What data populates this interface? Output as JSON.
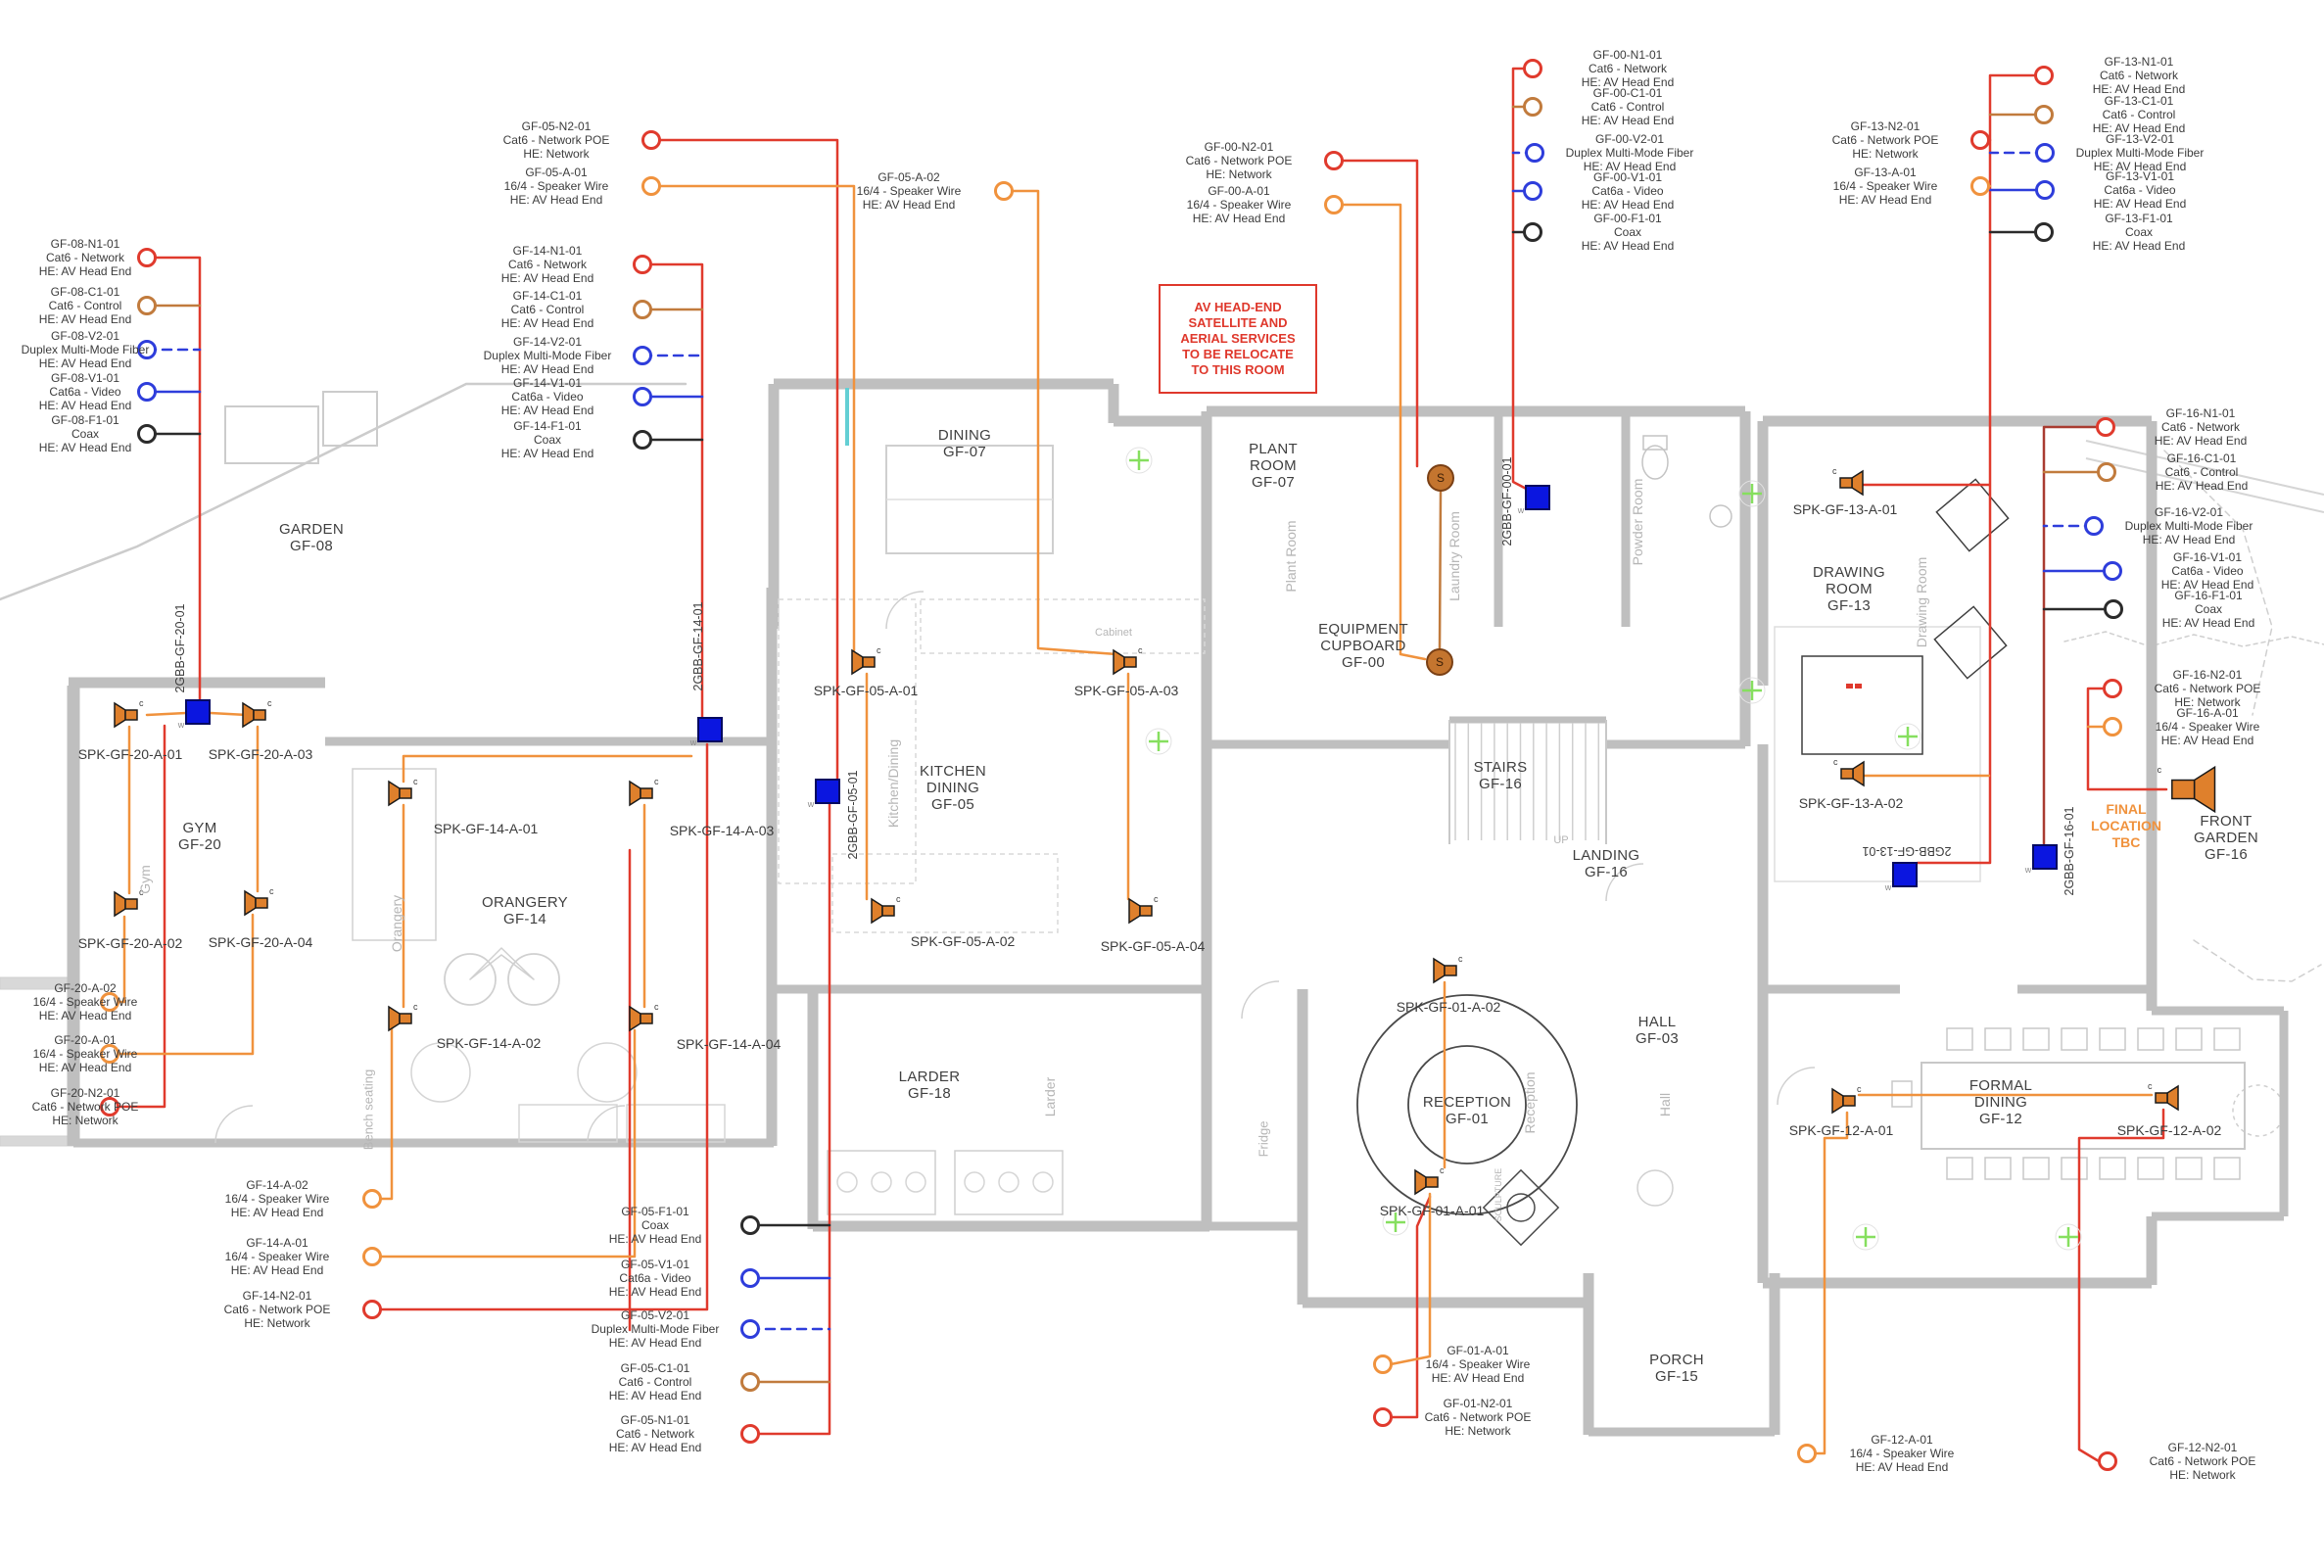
{
  "title": "Ground Floor AV / Speaker Cabling Plan",
  "colors": {
    "network": "#e03a2d",
    "network_poe": "#e03a2d",
    "control": "#c17b3d",
    "video": "#2e3ddb",
    "fiber": "#2e3ddb",
    "coax": "#2b2b2b",
    "speaker_wire": "#f0923d",
    "speaker_icon": "#df802c",
    "distribution_box": "#0b16e0",
    "wall_gray": "#bfbfbf",
    "annotation_gray": "#b6b6b6",
    "light_marker_green": "#86df5f",
    "note_red": "#df382c",
    "note_orange": "#f0923d"
  },
  "callout_groups": [
    {
      "name": "GF-08",
      "items": [
        {
          "id": "GF-08-N1-01",
          "cable": "Cat6 - Network",
          "dest": "HE: AV Head End",
          "type": "network"
        },
        {
          "id": "GF-08-C1-01",
          "cable": "Cat6 - Control",
          "dest": "HE: AV Head End",
          "type": "control"
        },
        {
          "id": "GF-08-V2-01",
          "cable": "Duplex Multi-Mode Fiber",
          "dest": "HE: AV Head End",
          "type": "fiber"
        },
        {
          "id": "GF-08-V1-01",
          "cable": "Cat6a - Video",
          "dest": "HE: AV Head End",
          "type": "video"
        },
        {
          "id": "GF-08-F1-01",
          "cable": "Coax",
          "dest": "HE: AV Head End",
          "type": "coax"
        }
      ]
    },
    {
      "name": "GF-05 head-end",
      "items": [
        {
          "id": "GF-05-N2-01",
          "cable": "Cat6 - Network POE",
          "dest": "HE: Network",
          "type": "network_poe"
        },
        {
          "id": "GF-05-A-01",
          "cable": "16/4 - Speaker Wire",
          "dest": "HE: AV Head End",
          "type": "speaker_wire"
        }
      ]
    },
    {
      "name": "GF-05 speaker 2",
      "items": [
        {
          "id": "GF-05-A-02",
          "cable": "16/4 - Speaker Wire",
          "dest": "HE: AV Head End",
          "type": "speaker_wire"
        }
      ]
    },
    {
      "name": "GF-14",
      "items": [
        {
          "id": "GF-14-N1-01",
          "cable": "Cat6 - Network",
          "dest": "HE: AV Head End",
          "type": "network"
        },
        {
          "id": "GF-14-C1-01",
          "cable": "Cat6 - Control",
          "dest": "HE: AV Head End",
          "type": "control"
        },
        {
          "id": "GF-14-V2-01",
          "cable": "Duplex Multi-Mode Fiber",
          "dest": "HE: AV Head End",
          "type": "fiber"
        },
        {
          "id": "GF-14-V1-01",
          "cable": "Cat6a - Video",
          "dest": "HE: AV Head End",
          "type": "video"
        },
        {
          "id": "GF-14-F1-01",
          "cable": "Coax",
          "dest": "HE: AV Head End",
          "type": "coax"
        }
      ]
    },
    {
      "name": "GF-00 poe",
      "items": [
        {
          "id": "GF-00-N2-01",
          "cable": "Cat6 - Network POE",
          "dest": "HE: Network",
          "type": "network_poe"
        },
        {
          "id": "GF-00-A-01",
          "cable": "16/4 - Speaker Wire",
          "dest": "HE: AV Head End",
          "type": "speaker_wire"
        }
      ]
    },
    {
      "name": "GF-00",
      "items": [
        {
          "id": "GF-00-N1-01",
          "cable": "Cat6 - Network",
          "dest": "HE: AV Head End",
          "type": "network"
        },
        {
          "id": "GF-00-C1-01",
          "cable": "Cat6 - Control",
          "dest": "HE: AV Head End",
          "type": "control"
        },
        {
          "id": "GF-00-V2-01",
          "cable": "Duplex Multi-Mode Fiber",
          "dest": "HE: AV Head End",
          "type": "fiber"
        },
        {
          "id": "GF-00-V1-01",
          "cable": "Cat6a - Video",
          "dest": "HE: AV Head End",
          "type": "video"
        },
        {
          "id": "GF-00-F1-01",
          "cable": "Coax",
          "dest": "HE: AV Head End",
          "type": "coax"
        }
      ]
    },
    {
      "name": "GF-13 poe",
      "items": [
        {
          "id": "GF-13-N2-01",
          "cable": "Cat6 - Network POE",
          "dest": "HE: Network",
          "type": "network_poe"
        },
        {
          "id": "GF-13-A-01",
          "cable": "16/4 - Speaker Wire",
          "dest": "HE: AV Head End",
          "type": "speaker_wire"
        }
      ]
    },
    {
      "name": "GF-13",
      "items": [
        {
          "id": "GF-13-N1-01",
          "cable": "Cat6 - Network",
          "dest": "HE: AV Head End",
          "type": "network"
        },
        {
          "id": "GF-13-C1-01",
          "cable": "Cat6 - Control",
          "dest": "HE: AV Head End",
          "type": "control"
        },
        {
          "id": "GF-13-V2-01",
          "cable": "Duplex Multi-Mode Fiber",
          "dest": "HE: AV Head End",
          "type": "fiber"
        },
        {
          "id": "GF-13-V1-01",
          "cable": "Cat6a - Video",
          "dest": "HE: AV Head End",
          "type": "video"
        },
        {
          "id": "GF-13-F1-01",
          "cable": "Coax",
          "dest": "HE: AV Head End",
          "type": "coax"
        }
      ]
    },
    {
      "name": "GF-16",
      "items": [
        {
          "id": "GF-16-N1-01",
          "cable": "Cat6 - Network",
          "dest": "HE: AV Head End",
          "type": "network"
        },
        {
          "id": "GF-16-C1-01",
          "cable": "Cat6 - Control",
          "dest": "HE: AV Head End",
          "type": "control"
        },
        {
          "id": "GF-16-V2-01",
          "cable": "Duplex Multi-Mode Fiber",
          "dest": "HE: AV Head End",
          "type": "fiber"
        },
        {
          "id": "GF-16-V1-01",
          "cable": "Cat6a - Video",
          "dest": "HE: AV Head End",
          "type": "video"
        },
        {
          "id": "GF-16-F1-01",
          "cable": "Coax",
          "dest": "HE: AV Head End",
          "type": "coax"
        }
      ]
    },
    {
      "name": "GF-16 poe",
      "items": [
        {
          "id": "GF-16-N2-01",
          "cable": "Cat6 - Network POE",
          "dest": "HE: Network",
          "type": "network_poe"
        },
        {
          "id": "GF-16-A-01",
          "cable": "16/4 - Speaker Wire",
          "dest": "HE: AV Head End",
          "type": "speaker_wire"
        }
      ]
    },
    {
      "name": "GF-20 tails",
      "items": [
        {
          "id": "GF-20-A-02",
          "cable": "16/4 - Speaker Wire",
          "dest": "HE: AV Head End",
          "type": "speaker_wire"
        },
        {
          "id": "GF-20-A-01",
          "cable": "16/4 - Speaker Wire",
          "dest": "HE: AV Head End",
          "type": "speaker_wire"
        },
        {
          "id": "GF-20-N2-01",
          "cable": "Cat6 - Network POE",
          "dest": "HE: Network",
          "type": "network_poe"
        }
      ]
    },
    {
      "name": "GF-14 tails",
      "items": [
        {
          "id": "GF-14-A-02",
          "cable": "16/4 - Speaker Wire",
          "dest": "HE: AV Head End",
          "type": "speaker_wire"
        },
        {
          "id": "GF-14-A-01",
          "cable": "16/4 - Speaker Wire",
          "dest": "HE: AV Head End",
          "type": "speaker_wire"
        },
        {
          "id": "GF-14-N2-01",
          "cable": "Cat6 - Network POE",
          "dest": "HE: Network",
          "type": "network_poe"
        }
      ]
    },
    {
      "name": "GF-05 tails",
      "items": [
        {
          "id": "GF-05-F1-01",
          "cable": "Coax",
          "dest": "HE: AV Head End",
          "type": "coax"
        },
        {
          "id": "GF-05-V1-01",
          "cable": "Cat6a - Video",
          "dest": "HE: AV Head End",
          "type": "video"
        },
        {
          "id": "GF-05-V2-01",
          "cable": "Duplex Multi-Mode Fiber",
          "dest": "HE: AV Head End",
          "type": "fiber"
        },
        {
          "id": "GF-05-C1-01",
          "cable": "Cat6 - Control",
          "dest": "HE: AV Head End",
          "type": "control"
        },
        {
          "id": "GF-05-N1-01",
          "cable": "Cat6 - Network",
          "dest": "HE: AV Head End",
          "type": "network"
        }
      ]
    },
    {
      "name": "GF-01 tails",
      "items": [
        {
          "id": "GF-01-A-01",
          "cable": "16/4 - Speaker Wire",
          "dest": "HE: AV Head End",
          "type": "speaker_wire"
        },
        {
          "id": "GF-01-N2-01",
          "cable": "Cat6 - Network POE",
          "dest": "HE: Network",
          "type": "network_poe"
        }
      ]
    },
    {
      "name": "GF-12 speaker",
      "items": [
        {
          "id": "GF-12-A-01",
          "cable": "16/4 - Speaker Wire",
          "dest": "HE: AV Head End",
          "type": "speaker_wire"
        }
      ]
    },
    {
      "name": "GF-12 poe",
      "items": [
        {
          "id": "GF-12-N2-01",
          "cable": "Cat6 - Network POE",
          "dest": "HE: Network",
          "type": "network_poe"
        }
      ]
    }
  ],
  "rooms": [
    {
      "lines": [
        "GARDEN",
        "GF-08"
      ]
    },
    {
      "lines": [
        "GYM",
        "GF-20"
      ]
    },
    {
      "lines": [
        "ORANGERY",
        "GF-14"
      ]
    },
    {
      "lines": [
        "DINING",
        "GF-07"
      ]
    },
    {
      "lines": [
        "KITCHEN",
        "DINING",
        "GF-05"
      ]
    },
    {
      "lines": [
        "LARDER",
        "GF-18"
      ]
    },
    {
      "lines": [
        "PLANT",
        "ROOM",
        "GF-07"
      ]
    },
    {
      "lines": [
        "EQUIPMENT",
        "CUPBOARD",
        "GF-00"
      ]
    },
    {
      "lines": [
        "STAIRS",
        "GF-16"
      ]
    },
    {
      "lines": [
        "LANDING",
        "GF-16"
      ]
    },
    {
      "lines": [
        "HALL",
        "GF-03"
      ]
    },
    {
      "lines": [
        "RECEPTION",
        "GF-01"
      ]
    },
    {
      "lines": [
        "PORCH",
        "GF-15"
      ]
    },
    {
      "lines": [
        "FORMAL",
        "DINING",
        "GF-12"
      ]
    },
    {
      "lines": [
        "DRAWING",
        "ROOM",
        "GF-13"
      ]
    },
    {
      "lines": [
        "FRONT",
        "GARDEN",
        "GF-16"
      ]
    }
  ],
  "speakers": [
    {
      "label": "SPK-GF-20-A-01",
      "marker": "c"
    },
    {
      "label": "SPK-GF-20-A-03",
      "marker": "c"
    },
    {
      "label": "SPK-GF-20-A-02",
      "marker": "c"
    },
    {
      "label": "SPK-GF-20-A-04",
      "marker": "c"
    },
    {
      "label": "SPK-GF-14-A-01",
      "marker": "c"
    },
    {
      "label": "SPK-GF-14-A-03",
      "marker": "c"
    },
    {
      "label": "SPK-GF-14-A-02",
      "marker": "c"
    },
    {
      "label": "SPK-GF-14-A-04",
      "marker": "c"
    },
    {
      "label": "SPK-GF-05-A-01",
      "marker": "c"
    },
    {
      "label": "SPK-GF-05-A-03",
      "marker": "c"
    },
    {
      "label": "SPK-GF-05-A-02",
      "marker": "c"
    },
    {
      "label": "SPK-GF-05-A-04",
      "marker": "c"
    },
    {
      "label": "SPK-GF-01-A-02",
      "marker": "c"
    },
    {
      "label": "SPK-GF-01-A-01",
      "marker": "c"
    },
    {
      "label": "SPK-GF-13-A-01",
      "marker": "c"
    },
    {
      "label": "SPK-GF-13-A-02",
      "marker": "c"
    },
    {
      "label": "SPK-GF-12-A-01",
      "marker": "c"
    },
    {
      "label": "SPK-GF-12-A-02",
      "marker": "c"
    }
  ],
  "tbc_speaker": {
    "marker": "c"
  },
  "boxes": [
    {
      "label": "2GBB-GF-20-01",
      "marker": "w"
    },
    {
      "label": "2GBB-GF-14-01",
      "marker": "w"
    },
    {
      "label": "2GBB-GF-05-01",
      "marker": "w"
    },
    {
      "label": "2GBB-GF-00-01",
      "marker": "w"
    },
    {
      "label": "2GBB-GF-13-01",
      "marker": "w"
    },
    {
      "label": "2GBB-GF-16-01",
      "marker": "w"
    }
  ],
  "satellite_markers": [
    {
      "label": "S"
    },
    {
      "label": "S"
    }
  ],
  "notes": {
    "relocate": {
      "lines": [
        "AV HEAD-END",
        "SATELLITE AND",
        "AERIAL SERVICES",
        "TO BE RELOCATE",
        "TO THIS ROOM"
      ]
    },
    "final_location": {
      "lines": [
        "FINAL",
        "LOCATION",
        "TBC"
      ]
    }
  },
  "area_annotations": [
    {
      "text": "Gym"
    },
    {
      "text": "Orangery"
    },
    {
      "text": "Bench seating"
    },
    {
      "text": "Kitchen/Dining"
    },
    {
      "text": "Larder"
    },
    {
      "text": "Fridge"
    },
    {
      "text": "Plant Room"
    },
    {
      "text": "Laundry Room"
    },
    {
      "text": "Powder Room"
    },
    {
      "text": "Hall"
    },
    {
      "text": "Reception"
    },
    {
      "text": "SCULPTURE"
    },
    {
      "text": "Drawing Room"
    },
    {
      "text": "UP"
    },
    {
      "text": "Cabinet"
    }
  ]
}
